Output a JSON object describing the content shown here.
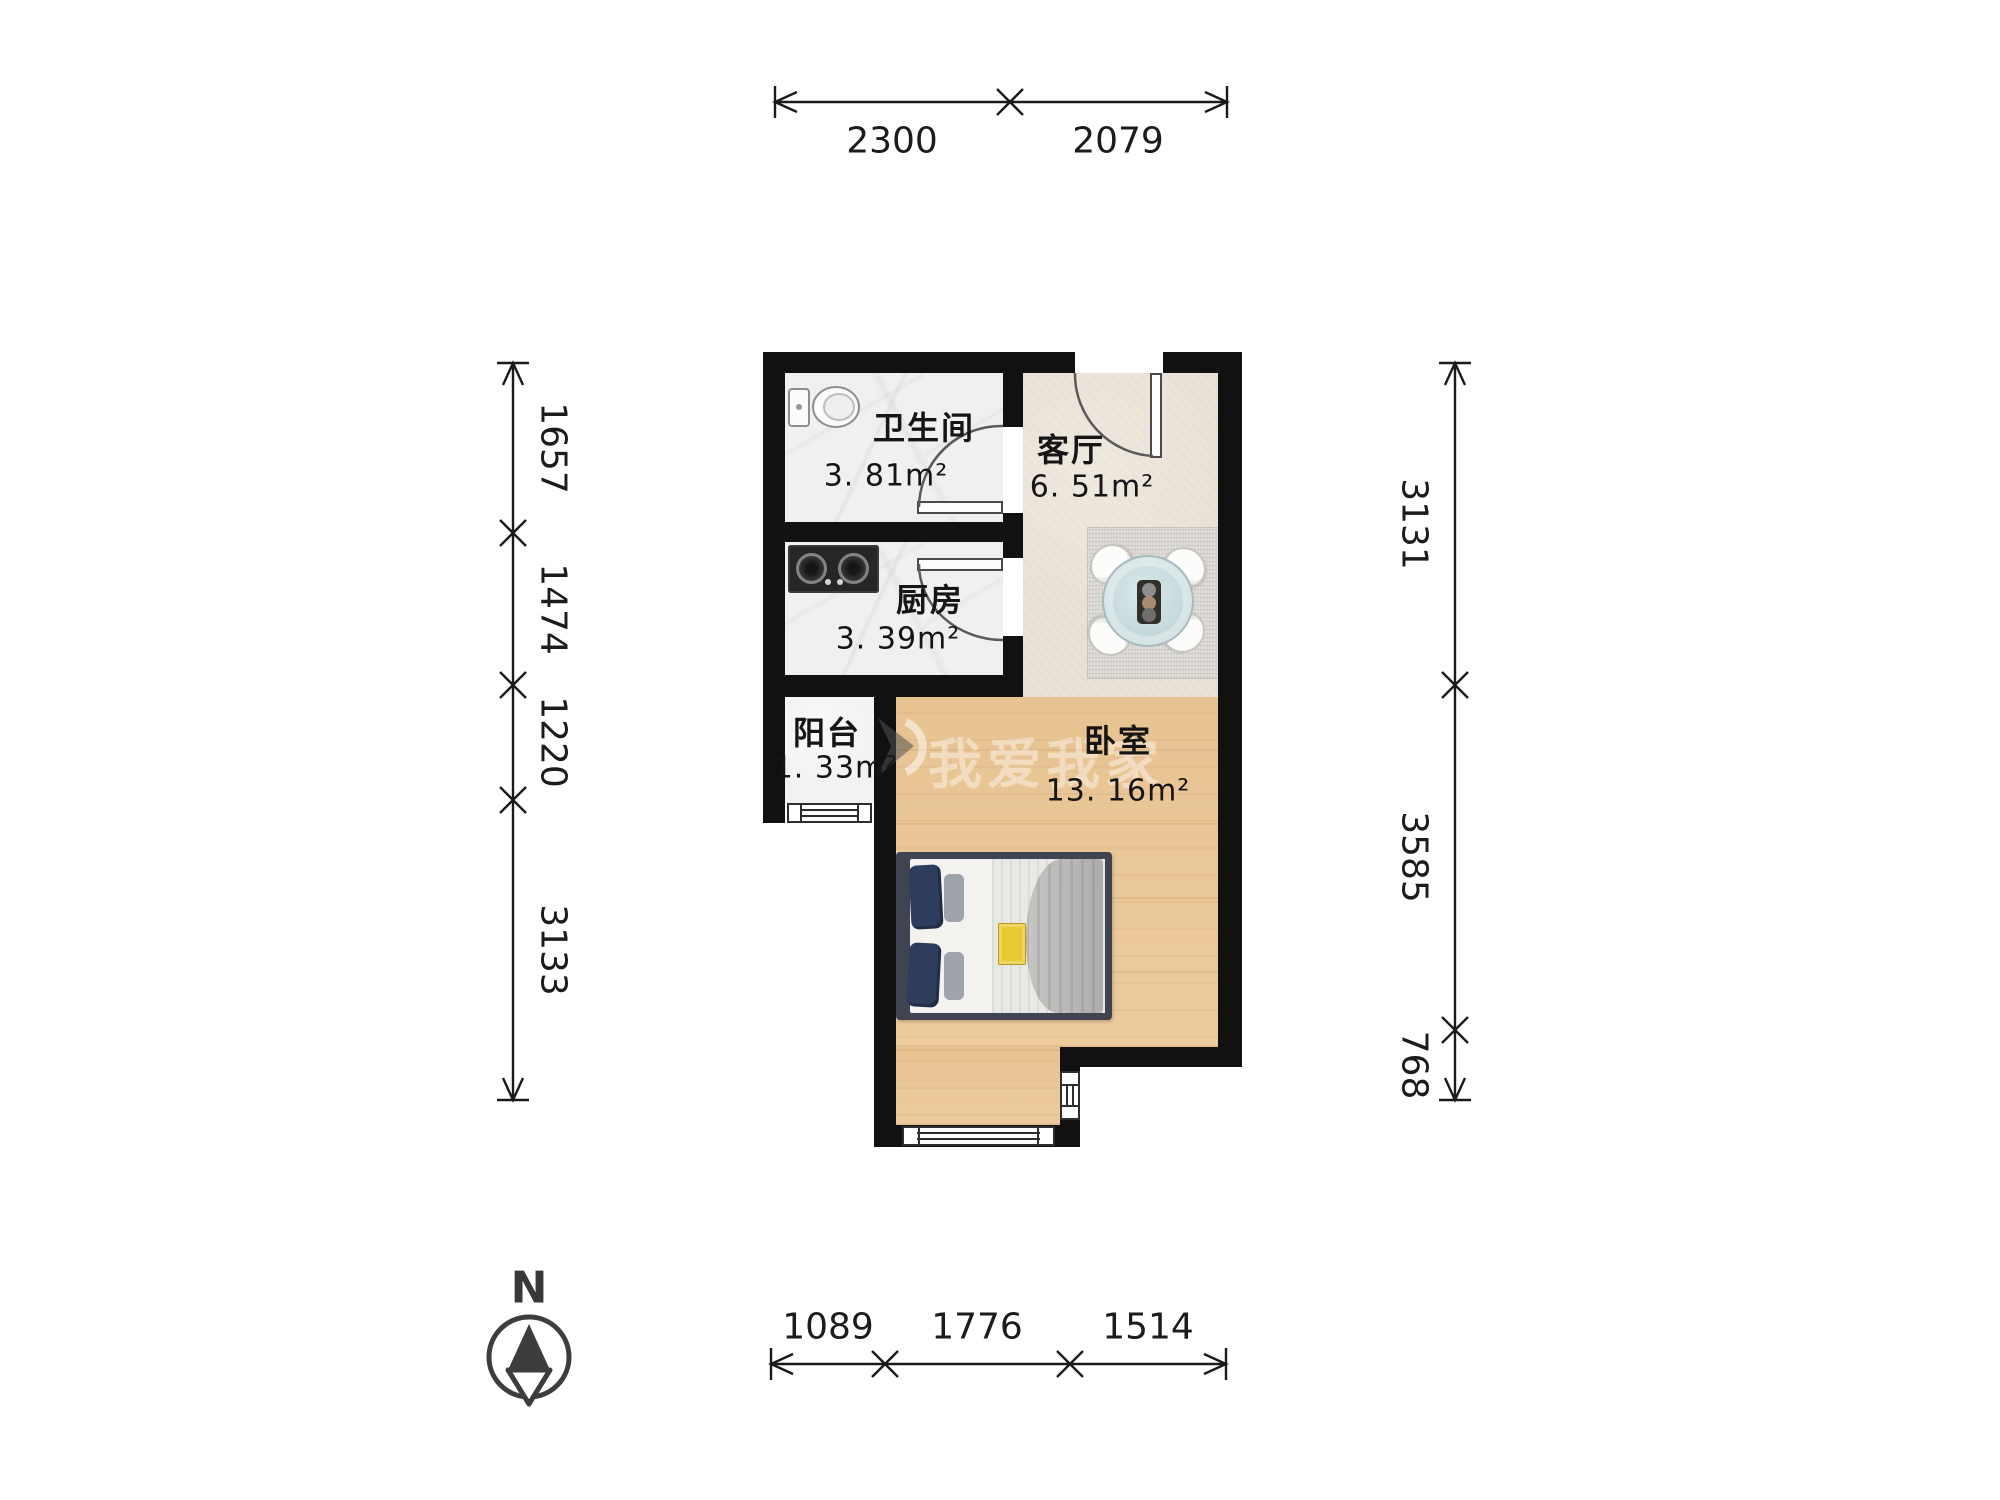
{
  "rooms": {
    "bathroom": {
      "name": "卫生间",
      "area": "3. 81m²"
    },
    "kitchen": {
      "name": "厨房",
      "area": "3. 39m²"
    },
    "living": {
      "name": "客厅",
      "area": "6. 51m²"
    },
    "balcony": {
      "name": "阳台",
      "area": "1. 33m²"
    },
    "bedroom": {
      "name": "卧室",
      "area": "13. 16m²"
    }
  },
  "dimensions": {
    "top": [
      "2300",
      "2079"
    ],
    "bottom": [
      "1089",
      "1776",
      "1514"
    ],
    "left": [
      "1657",
      "1474",
      "1220",
      "3133"
    ],
    "right": [
      "3131",
      "3585",
      "768"
    ]
  },
  "compass": {
    "label": "N"
  },
  "watermark": {
    "text": "我爱我家"
  },
  "colors": {
    "wall": "#111111",
    "wood_floor": "#ecc795",
    "tile_floor": "#e9e1d5",
    "marble_floor": "#f1f0ee",
    "balcony_floor": "#f2f2f1",
    "dimension_text": "#1c1c1c",
    "label_text": "#151515",
    "bed_frame": "#3f4450",
    "pillow_navy": "#2e3c5e",
    "table_glass": "#c6dadc"
  }
}
